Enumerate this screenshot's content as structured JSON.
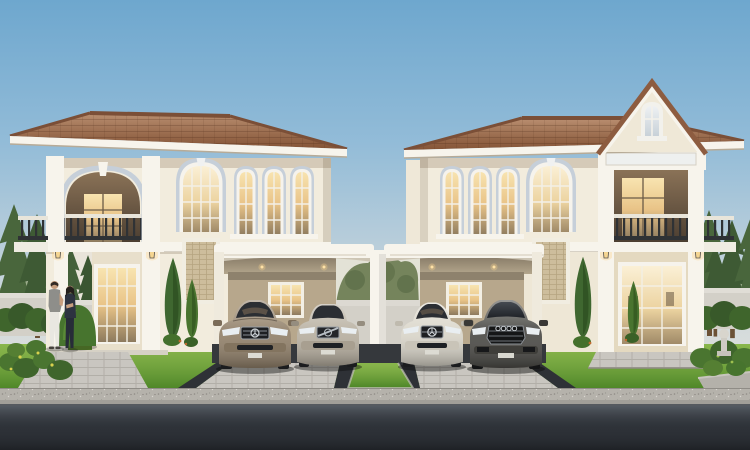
{
  "scene": {
    "kind": "architectural-rendering",
    "description": "Twin two-storey cream houses with terracotta hip roofs and a shared double carport; four luxury cars parked; a couple talking in the front garden; paver driveways, lawns, pine trees and an asphalt road in the foreground",
    "objects": {
      "left_house": "two-storey house with arched balcony, tall arched stair window and three narrow arched windows",
      "right_house": "two-storey house with front gable, balcony with entablature, tall arched window and three narrow arched windows",
      "carport": "shared carport with white arched beams, central column, recessed downlights and lit back windows",
      "cars": [
        {
          "position": "left-bay-left",
          "type": "luxury sedan",
          "color_name": "champagne bronze"
        },
        {
          "position": "left-bay-right",
          "type": "estate wagon",
          "color_name": "silver beige"
        },
        {
          "position": "right-bay-left",
          "type": "coupe",
          "color_name": "pearl white"
        },
        {
          "position": "right-bay-right",
          "type": "luxury sedan",
          "color_name": "graphite grey"
        }
      ],
      "people": [
        {
          "who": "man",
          "outfit": "grey t-shirt, white trousers"
        },
        {
          "who": "woman",
          "outfit": "dark navy top and trousers"
        }
      ],
      "landscaping": "pine trees, trimmed dome hedges, cypress trees, flowering shrubs, lawn strips, garden walls, stone urn"
    }
  },
  "palette": {
    "sky_top": "#6ea7ce",
    "sky_horizon": "#ece6dc",
    "roof_tile": "#9c6a4b",
    "roof_ridge": "#7b4f37",
    "wall_cream": "#f2ecdd",
    "wall_tan": "#b7a78c",
    "trim_white": "#f7f4ec",
    "arch_molding": "#c6cfd9",
    "glass_warm": "#f0d49a",
    "interior_dark": "#5d4f3f",
    "railing_iron": "#2f3235",
    "grass": "#6ca437",
    "hedge": "#3f652c",
    "pine": "#49663c",
    "tree_olive": "#75845c",
    "garden_wall": "#d3d0c8",
    "paver_border": "#2e3136",
    "sidewalk": "#b5b2ab",
    "road_dark": "#2c3036",
    "car1_body": "#94836c",
    "car2_body": "#b9b1a2",
    "car3_body": "#dbd7cb",
    "car4_body": "#4d4c48",
    "car_glass": "#2b2e33",
    "headlight": "#e9eef1",
    "skin": "#c79e7e",
    "man_shirt": "#8e8e8a",
    "man_pants": "#e9e7e1",
    "woman_outfit": "#2d3340",
    "lamp_glow": "#ffd98e"
  }
}
